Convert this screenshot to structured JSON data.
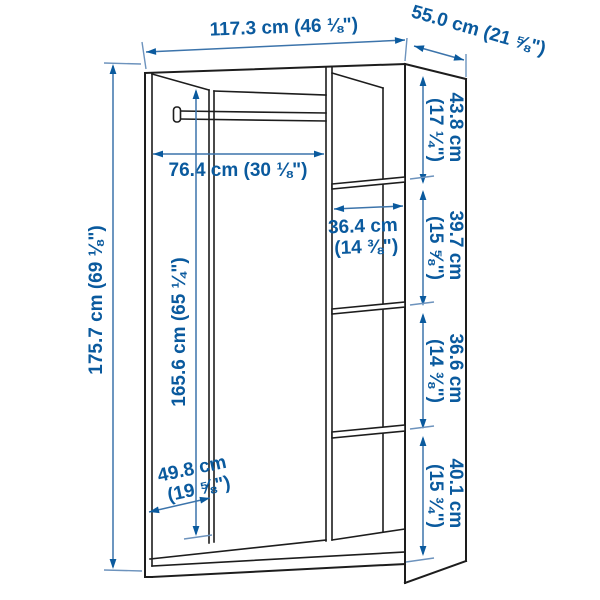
{
  "diagram": {
    "title": "wardrobe dimension diagram",
    "style": "technical line drawing with measurement arrows",
    "colors": {
      "outline": "#1d1d1d",
      "dimension_line": "#3c74ab",
      "dimension_text": "#0a5a9e",
      "background": "#ffffff"
    },
    "dimensions": {
      "width_overall": {
        "cm": "117.3 cm",
        "inches": "(46 ⅛\")",
        "label": "117.3 cm (46 ⅛\")"
      },
      "depth_overall": {
        "cm": "55.0 cm",
        "inches": "(21 ⅝\")",
        "label": "55.0 cm (21 ⅝\")"
      },
      "height_overall": {
        "cm": "175.7 cm",
        "inches": "(69 ⅛\")",
        "label": "175.7 cm (69 ⅛\")"
      },
      "rail_clearance_width": {
        "cm": "76.4 cm",
        "inches": "(30 ⅛\")",
        "label": "76.4 cm (30 ⅛\")"
      },
      "interior_height": {
        "cm": "165.6 cm",
        "inches": "(65 ¼\")",
        "label": "165.6 cm (65 ¼\")"
      },
      "shelf_width": {
        "cm": "36.4 cm",
        "inches": "(14 ⅜\")",
        "label": "36.4 cm (14 ⅜\")"
      },
      "interior_depth": {
        "cm": "49.8 cm",
        "inches": "(19 ⅝\")",
        "label": "49.8 cm (19 ⅝\")"
      },
      "section_top": {
        "cm": "43.8 cm",
        "inches": "(17 ¼\")",
        "label": "43.8 cm (17 ¼\")"
      },
      "section_upper_mid": {
        "cm": "39.7 cm",
        "inches": "(15 ⅝\")",
        "label": "39.7 cm (15 ⅝\")"
      },
      "section_lower_mid": {
        "cm": "36.6 cm",
        "inches": "(14 ⅜\")",
        "label": "36.6 cm (14 ⅜\")"
      },
      "section_bottom": {
        "cm": "40.1 cm",
        "inches": "(15 ¾\")",
        "label": "40.1 cm (15 ¾\")"
      }
    }
  }
}
